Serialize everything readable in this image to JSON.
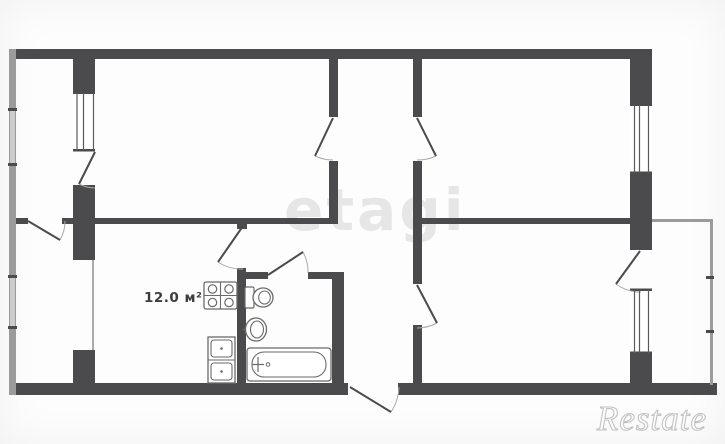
{
  "meta": {
    "width": 725,
    "height": 444,
    "background": "#ffffff"
  },
  "labels": {
    "area_label": "12.0 м²"
  },
  "watermarks": {
    "center": "etagi",
    "corner": "Restate"
  },
  "colors": {
    "wall": "#4b4b4d",
    "thin_wall": "#9b9b9b",
    "window_band": "#cccccc",
    "fixture": "#6a6a6a",
    "door_arc": "#a9a9a9",
    "glazing": "#5a5a5a",
    "center_watermark": "#e6e6e6",
    "label_text": "#3d3d3d"
  },
  "plan": {
    "rects": [
      {
        "x": 10,
        "y": 49,
        "w": 642,
        "h": 10,
        "f": "#4b4b4d",
        "n": "outer-wall-top"
      },
      {
        "x": 10,
        "y": 383,
        "w": 338,
        "h": 12,
        "f": "#4b4b4d",
        "n": "outer-wall-bottom-left"
      },
      {
        "x": 398,
        "y": 383,
        "w": 319,
        "h": 12,
        "f": "#4b4b4d",
        "n": "outer-wall-bottom-right"
      },
      {
        "x": 630,
        "y": 49,
        "w": 22,
        "h": 56,
        "f": "#4b4b4d",
        "n": "outer-wall-right-upper"
      },
      {
        "x": 630,
        "y": 173,
        "w": 22,
        "h": 77,
        "f": "#4b4b4d",
        "n": "outer-wall-right-mid"
      },
      {
        "x": 630,
        "y": 353,
        "w": 22,
        "h": 42,
        "f": "#4b4b4d",
        "n": "outer-wall-right-lower"
      },
      {
        "x": 73,
        "y": 49,
        "w": 22,
        "h": 44,
        "f": "#4b4b4d",
        "n": "left-partition-pier-top"
      },
      {
        "x": 73,
        "y": 185,
        "w": 22,
        "h": 75,
        "f": "#4b4b4d",
        "n": "left-partition-pier-mid"
      },
      {
        "x": 73,
        "y": 350,
        "w": 22,
        "h": 45,
        "f": "#4b4b4d",
        "n": "left-partition-pier-bottom"
      },
      {
        "x": 9,
        "y": 218,
        "w": 19,
        "h": 6,
        "f": "#4b4b4d",
        "n": "mid-wall-left-stub"
      },
      {
        "x": 62,
        "y": 218,
        "w": 11,
        "h": 6,
        "f": "#4b4b4d",
        "n": "mid-wall-left-stub"
      },
      {
        "x": 95,
        "y": 218,
        "w": 240,
        "h": 6,
        "f": "#4b4b4d",
        "n": "mid-wall-main"
      },
      {
        "x": 421,
        "y": 218,
        "w": 209,
        "h": 6,
        "f": "#4b4b4d",
        "n": "mid-wall-right"
      },
      {
        "x": 329,
        "y": 56,
        "w": 9,
        "h": 61,
        "f": "#4b4b4d",
        "n": "hall-wall-left-upper"
      },
      {
        "x": 329,
        "y": 161,
        "w": 9,
        "h": 63,
        "f": "#4b4b4d",
        "n": "hall-wall-left-lower"
      },
      {
        "x": 413,
        "y": 56,
        "w": 9,
        "h": 61,
        "f": "#4b4b4d",
        "n": "hall-wall-right-upper"
      },
      {
        "x": 413,
        "y": 161,
        "w": 9,
        "h": 123,
        "f": "#4b4b4d",
        "n": "hall-wall-right-mid"
      },
      {
        "x": 413,
        "y": 325,
        "w": 9,
        "h": 70,
        "f": "#4b4b4d",
        "n": "hall-wall-right-lower"
      },
      {
        "x": 237,
        "y": 224,
        "w": 10,
        "h": 5,
        "f": "#4b4b4d",
        "n": "kitchen-door-pier"
      },
      {
        "x": 237,
        "y": 268,
        "w": 9,
        "h": 115,
        "f": "#4b4b4d",
        "n": "kitchen-bath-wall"
      },
      {
        "x": 237,
        "y": 272,
        "w": 31,
        "h": 7,
        "f": "#4b4b4d",
        "n": "bath-wall-top-left"
      },
      {
        "x": 308,
        "y": 272,
        "w": 36,
        "h": 7,
        "f": "#4b4b4d",
        "n": "bath-wall-top-right"
      },
      {
        "x": 332,
        "y": 272,
        "w": 12,
        "h": 111,
        "f": "#4b4b4d",
        "n": "bath-wall-right"
      },
      {
        "x": 9,
        "y": 49,
        "w": 7,
        "h": 346,
        "f": "#9b9b9b",
        "n": "outer-wall-left-thin"
      },
      {
        "x": 10,
        "y": 110,
        "w": 5,
        "h": 55,
        "f": "#cccccc",
        "n": "left-window-band"
      },
      {
        "x": 10,
        "y": 277,
        "w": 5,
        "h": 51,
        "f": "#cccccc",
        "n": "left-window-band"
      },
      {
        "x": 652,
        "y": 219,
        "w": 61,
        "h": 3,
        "f": "#9b9b9b",
        "n": "loggia-wall-top"
      },
      {
        "x": 710,
        "y": 219,
        "w": 3,
        "h": 166,
        "f": "#9b9b9b",
        "n": "loggia-wall-right"
      },
      {
        "x": 92,
        "y": 260,
        "w": 2,
        "h": 90,
        "f": "#ababab",
        "n": "kitchen-loggia-window"
      },
      {
        "x": 8,
        "y": 108,
        "w": 9,
        "h": 3,
        "f": "#4b4b4d",
        "n": "window-tick"
      },
      {
        "x": 8,
        "y": 163,
        "w": 9,
        "h": 3,
        "f": "#4b4b4d",
        "n": "window-tick"
      },
      {
        "x": 8,
        "y": 275,
        "w": 9,
        "h": 3,
        "f": "#4b4b4d",
        "n": "window-tick"
      },
      {
        "x": 8,
        "y": 326,
        "w": 9,
        "h": 3,
        "f": "#4b4b4d",
        "n": "window-tick"
      },
      {
        "x": 706,
        "y": 276,
        "w": 8,
        "h": 3,
        "f": "#4b4b4d",
        "n": "loggia-tick"
      },
      {
        "x": 706,
        "y": 330,
        "w": 8,
        "h": 3,
        "f": "#4b4b4d",
        "n": "loggia-tick"
      },
      {
        "x": 73,
        "y": 93,
        "w": 22,
        "h": 57,
        "f": "#ffffff",
        "n": "window-opening"
      },
      {
        "x": 73,
        "y": 91.5,
        "w": 22,
        "h": 2.5,
        "f": "#4b4b4d",
        "n": "window-cap"
      },
      {
        "x": 73,
        "y": 149,
        "w": 22,
        "h": 2.5,
        "f": "#4b4b4d",
        "n": "window-cap"
      },
      {
        "x": 630,
        "y": 105,
        "w": 22,
        "h": 68,
        "f": "#ffffff",
        "n": "window-opening"
      },
      {
        "x": 630,
        "y": 103.5,
        "w": 22,
        "h": 2.5,
        "f": "#4b4b4d",
        "n": "window-cap"
      },
      {
        "x": 630,
        "y": 171.5,
        "w": 22,
        "h": 2.5,
        "f": "#4b4b4d",
        "n": "window-cap"
      },
      {
        "x": 630,
        "y": 290,
        "w": 22,
        "h": 63,
        "f": "#ffffff",
        "n": "window-opening"
      },
      {
        "x": 630,
        "y": 288.5,
        "w": 22,
        "h": 2.5,
        "f": "#4b4b4d",
        "n": "window-cap"
      },
      {
        "x": 630,
        "y": 351.5,
        "w": 22,
        "h": 2.5,
        "f": "#4b4b4d",
        "n": "window-cap"
      },
      {
        "x": 204,
        "y": 282,
        "w": 33,
        "h": 27,
        "f": "#ffffff",
        "s": "#6a6a6a",
        "sw": 1.3,
        "rx": 2,
        "n": "stove"
      },
      {
        "x": 208,
        "y": 337,
        "w": 27,
        "h": 46,
        "f": "#ffffff",
        "s": "#6a6a6a",
        "sw": 1.3,
        "n": "kitchen-sink"
      },
      {
        "x": 211,
        "y": 340,
        "w": 21,
        "h": 17,
        "f": "#ffffff",
        "s": "#6a6a6a",
        "sw": 1.1,
        "rx": 3,
        "n": "sink-basin"
      },
      {
        "x": 211,
        "y": 363,
        "w": 21,
        "h": 17,
        "f": "#ffffff",
        "s": "#6a6a6a",
        "sw": 1.1,
        "rx": 3,
        "n": "sink-basin"
      },
      {
        "x": 245,
        "y": 287,
        "w": 9,
        "h": 21,
        "f": "#ffffff",
        "s": "#6a6a6a",
        "sw": 1.2,
        "rx": 1.5,
        "n": "toilet-tank"
      },
      {
        "x": 247,
        "y": 348,
        "w": 84,
        "h": 33,
        "f": "#ffffff",
        "s": "#6a6a6a",
        "sw": 1.3,
        "rx": 3,
        "n": "bathtub"
      },
      {
        "x": 252,
        "y": 352,
        "w": 74,
        "h": 25,
        "f": "#ffffff",
        "s": "#6a6a6a",
        "sw": 1.1,
        "rx": 12,
        "n": "bathtub-inner"
      }
    ],
    "lines": [
      {
        "x1": 77,
        "y1": 93,
        "x2": 77,
        "y2": 150,
        "c": "#5a5a5a",
        "w": 1.2,
        "n": "window-glazing"
      },
      {
        "x1": 83.5,
        "y1": 93,
        "x2": 83.5,
        "y2": 150,
        "c": "#5a5a5a",
        "w": 1.2,
        "n": "window-glazing"
      },
      {
        "x1": 93.5,
        "y1": 93,
        "x2": 93.5,
        "y2": 150,
        "c": "#5a5a5a",
        "w": 1.2,
        "n": "window-glazing"
      },
      {
        "x1": 634.5,
        "y1": 105,
        "x2": 634.5,
        "y2": 173,
        "c": "#5a5a5a",
        "w": 1.2,
        "n": "window-glazing"
      },
      {
        "x1": 639.5,
        "y1": 105,
        "x2": 639.5,
        "y2": 173,
        "c": "#5a5a5a",
        "w": 1.2,
        "n": "window-glazing"
      },
      {
        "x1": 648.5,
        "y1": 105,
        "x2": 648.5,
        "y2": 173,
        "c": "#5a5a5a",
        "w": 1.2,
        "n": "window-glazing"
      },
      {
        "x1": 634.5,
        "y1": 290,
        "x2": 634.5,
        "y2": 353,
        "c": "#5a5a5a",
        "w": 1.2,
        "n": "window-glazing"
      },
      {
        "x1": 639.5,
        "y1": 290,
        "x2": 639.5,
        "y2": 353,
        "c": "#5a5a5a",
        "w": 1.2,
        "n": "window-glazing"
      },
      {
        "x1": 648.5,
        "y1": 290,
        "x2": 648.5,
        "y2": 353,
        "c": "#5a5a5a",
        "w": 1.2,
        "n": "window-glazing"
      },
      {
        "x1": 95,
        "y1": 152,
        "x2": 79,
        "y2": 184,
        "c": "#4b4b4d",
        "w": 2,
        "n": "door-leaf"
      },
      {
        "x1": 28,
        "y1": 221,
        "x2": 60,
        "y2": 240,
        "c": "#4b4b4d",
        "w": 2,
        "n": "door-leaf"
      },
      {
        "x1": 333,
        "y1": 118,
        "x2": 315,
        "y2": 156,
        "c": "#4b4b4d",
        "w": 2,
        "n": "door-leaf"
      },
      {
        "x1": 417,
        "y1": 118,
        "x2": 436,
        "y2": 156,
        "c": "#4b4b4d",
        "w": 2,
        "n": "door-leaf"
      },
      {
        "x1": 417,
        "y1": 285,
        "x2": 437,
        "y2": 323,
        "c": "#4b4b4d",
        "w": 2,
        "n": "door-leaf"
      },
      {
        "x1": 640,
        "y1": 251,
        "x2": 616,
        "y2": 284,
        "c": "#4b4b4d",
        "w": 2,
        "n": "door-leaf"
      },
      {
        "x1": 243,
        "y1": 226,
        "x2": 218,
        "y2": 262,
        "c": "#4b4b4d",
        "w": 2,
        "n": "door-leaf"
      },
      {
        "x1": 268,
        "y1": 275,
        "x2": 303,
        "y2": 252,
        "c": "#4b4b4d",
        "w": 2,
        "n": "door-leaf"
      },
      {
        "x1": 350,
        "y1": 387,
        "x2": 391,
        "y2": 412,
        "c": "#4b4b4d",
        "w": 2,
        "n": "entrance-door-leaf"
      },
      {
        "x1": 220.5,
        "y1": 282,
        "x2": 220.5,
        "y2": 309,
        "c": "#6a6a6a",
        "w": 1.1,
        "n": "stove-divider"
      },
      {
        "x1": 204,
        "y1": 295.5,
        "x2": 237,
        "y2": 295.5,
        "c": "#6a6a6a",
        "w": 1.1,
        "n": "stove-divider"
      },
      {
        "x1": 208,
        "y1": 360,
        "x2": 235,
        "y2": 360,
        "c": "#6a6a6a",
        "w": 1.1,
        "n": "sink-divider"
      },
      {
        "x1": 246.5,
        "y1": 325,
        "x2": 246.5,
        "y2": 334,
        "c": "#6a6a6a",
        "w": 1.4,
        "n": "basin-tap"
      },
      {
        "x1": 243,
        "y1": 329.5,
        "x2": 250,
        "y2": 329.5,
        "c": "#6a6a6a",
        "w": 1.4,
        "n": "basin-tap"
      },
      {
        "x1": 258,
        "y1": 357,
        "x2": 258,
        "y2": 372,
        "c": "#6a6a6a",
        "w": 1.2,
        "n": "tub-tap"
      },
      {
        "x1": 252,
        "y1": 364.5,
        "x2": 264,
        "y2": 364.5,
        "c": "#6a6a6a",
        "w": 1.2,
        "n": "tub-tap"
      }
    ],
    "paths": [
      {
        "d": "M 79 184 A 36 36 0 0 0 95 188",
        "c": "#a9a9a9",
        "w": 1,
        "n": "door-arc"
      },
      {
        "d": "M 60 240 A 37 37 0 0 0 65 221",
        "c": "#a9a9a9",
        "w": 1,
        "n": "door-arc"
      },
      {
        "d": "M 315 156 A 42 42 0 0 0 333 160",
        "c": "#a9a9a9",
        "w": 1,
        "n": "door-arc"
      },
      {
        "d": "M 436 156 A 42 42 0 0 1 417 160",
        "c": "#a9a9a9",
        "w": 1,
        "n": "door-arc"
      },
      {
        "d": "M 437 323 A 43 43 0 0 1 417 328",
        "c": "#a9a9a9",
        "w": 1,
        "n": "door-arc"
      },
      {
        "d": "M 616 284 A 41 41 0 0 0 641 292",
        "c": "#a9a9a9",
        "w": 1,
        "n": "door-arc"
      },
      {
        "d": "M 218 262 A 43 43 0 0 0 243 269",
        "c": "#a9a9a9",
        "w": 1,
        "n": "door-arc"
      },
      {
        "d": "M 303 252 A 42 42 0 0 1 308 273",
        "c": "#a9a9a9",
        "w": 1,
        "n": "door-arc"
      },
      {
        "d": "M 391 412 A 49 49 0 0 0 399 387",
        "c": "#a9a9a9",
        "w": 1,
        "n": "entrance-door-arc"
      }
    ],
    "ellipses": [
      {
        "cx": 212.5,
        "cy": 289,
        "rx": 4.2,
        "ry": 4.2,
        "c": "#6a6a6a",
        "w": 1.2,
        "f": "none",
        "n": "stove-burner"
      },
      {
        "cx": 229,
        "cy": 289,
        "rx": 4.2,
        "ry": 4.2,
        "c": "#6a6a6a",
        "w": 1.2,
        "f": "none",
        "n": "stove-burner"
      },
      {
        "cx": 212.5,
        "cy": 302.5,
        "rx": 4.2,
        "ry": 4.2,
        "c": "#6a6a6a",
        "w": 1.2,
        "f": "none",
        "n": "stove-burner"
      },
      {
        "cx": 229,
        "cy": 302.5,
        "rx": 4.2,
        "ry": 4.2,
        "c": "#6a6a6a",
        "w": 1.2,
        "f": "none",
        "n": "stove-burner"
      },
      {
        "cx": 221.5,
        "cy": 348.5,
        "rx": 1.3,
        "ry": 1.3,
        "c": "none",
        "w": 0,
        "f": "#6a6a6a",
        "n": "sink-drain"
      },
      {
        "cx": 221.5,
        "cy": 371.5,
        "rx": 1.3,
        "ry": 1.3,
        "c": "none",
        "w": 0,
        "f": "#6a6a6a",
        "n": "sink-drain"
      },
      {
        "cx": 263,
        "cy": 297.5,
        "rx": 10,
        "ry": 9.5,
        "c": "#6a6a6a",
        "w": 1.3,
        "f": "#ffffff",
        "n": "toilet-bowl"
      },
      {
        "cx": 264.5,
        "cy": 297.5,
        "rx": 5.8,
        "ry": 6.5,
        "c": "#6a6a6a",
        "w": 1.1,
        "f": "none",
        "n": "toilet-bowl-inner"
      },
      {
        "cx": 256,
        "cy": 329.5,
        "rx": 10.5,
        "ry": 11.5,
        "c": "#6a6a6a",
        "w": 1.3,
        "f": "#ffffff",
        "n": "washbasin"
      },
      {
        "cx": 257,
        "cy": 329.5,
        "rx": 6.5,
        "ry": 8.5,
        "c": "#6a6a6a",
        "w": 1.1,
        "f": "none",
        "n": "washbasin-inner"
      },
      {
        "cx": 268,
        "cy": 364.5,
        "rx": 1.8,
        "ry": 1.8,
        "c": "#6a6a6a",
        "w": 1,
        "f": "none",
        "n": "tub-drain"
      }
    ]
  }
}
